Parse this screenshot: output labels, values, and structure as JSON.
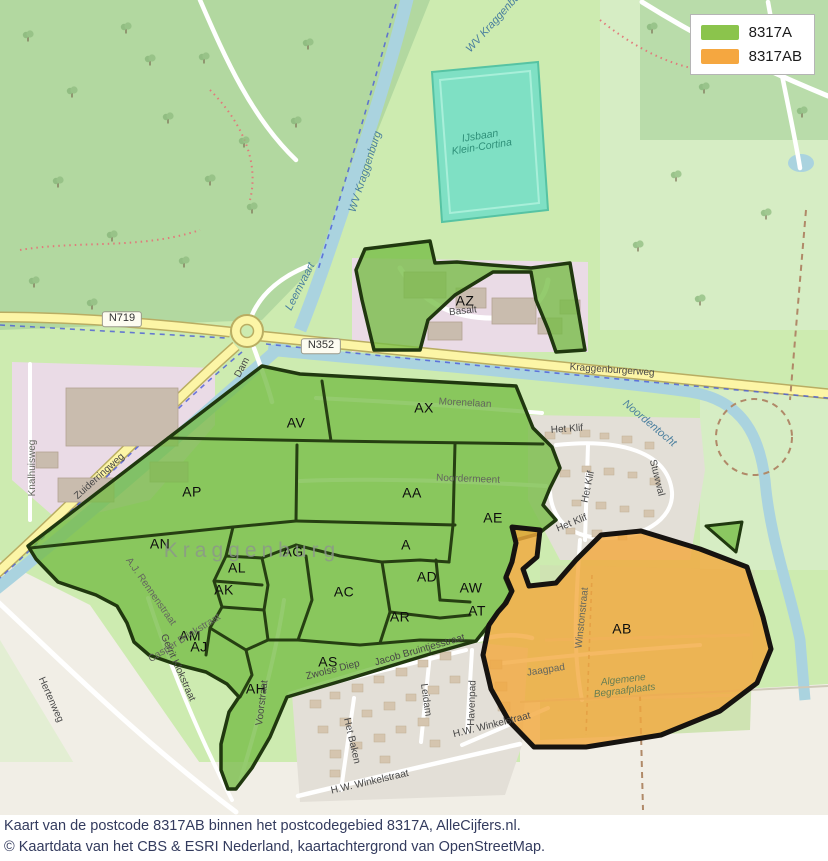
{
  "legend": {
    "items": [
      {
        "label": "8317A",
        "color": "#8bc44c"
      },
      {
        "label": "8317AB",
        "color": "#f5a740"
      }
    ]
  },
  "caption": {
    "line1": "Kaart van de postcode 8317AB binnen het postcodegebied 8317A, AlleCijfers.nl.",
    "line2": "© Kaartdata van het CBS & ESRI Nederland, kaartachtergrond van OpenStreetMap."
  },
  "map": {
    "colors": {
      "region_green_fill": "#76bc45",
      "region_orange_fill": "#f3a73c",
      "region_border_green": "#20380f",
      "region_border_black": "#161310",
      "water": "#aad3df",
      "road_yellow": "#fcf5a6",
      "forest": "#b2d8a0",
      "industrial_pink": "#eadbe6",
      "residential_grey": "#e3dfd7",
      "beige": "#f1eee6"
    },
    "labels": [
      {
        "kind": "region",
        "name": "region-label-az",
        "text": "AZ",
        "x": 465,
        "y": 301,
        "rot": 0
      },
      {
        "kind": "region",
        "name": "region-label-ax",
        "text": "AX",
        "x": 424,
        "y": 408,
        "rot": 0
      },
      {
        "kind": "region",
        "name": "region-label-av",
        "text": "AV",
        "x": 296,
        "y": 423,
        "rot": 0
      },
      {
        "kind": "region",
        "name": "region-label-ap",
        "text": "AP",
        "x": 192,
        "y": 492,
        "rot": 0
      },
      {
        "kind": "region",
        "name": "region-label-aa",
        "text": "AA",
        "x": 412,
        "y": 493,
        "rot": 0
      },
      {
        "kind": "region",
        "name": "region-label-ae",
        "text": "AE",
        "x": 493,
        "y": 518,
        "rot": 0
      },
      {
        "kind": "region",
        "name": "region-label-an",
        "text": "AN",
        "x": 160,
        "y": 544,
        "rot": 0
      },
      {
        "kind": "region",
        "name": "region-label-a",
        "text": "A",
        "x": 406,
        "y": 545,
        "rot": 0
      },
      {
        "kind": "region",
        "name": "region-label-ag",
        "text": "AG",
        "x": 293,
        "y": 552,
        "rot": 0
      },
      {
        "kind": "region",
        "name": "region-label-al",
        "text": "AL",
        "x": 237,
        "y": 568,
        "rot": 0
      },
      {
        "kind": "region",
        "name": "region-label-ak",
        "text": "AK",
        "x": 224,
        "y": 590,
        "rot": 0
      },
      {
        "kind": "region",
        "name": "region-label-ac",
        "text": "AC",
        "x": 344,
        "y": 592,
        "rot": 0
      },
      {
        "kind": "region",
        "name": "region-label-ad",
        "text": "AD",
        "x": 427,
        "y": 577,
        "rot": 0
      },
      {
        "kind": "region",
        "name": "region-label-aw",
        "text": "AW",
        "x": 471,
        "y": 588,
        "rot": 0
      },
      {
        "kind": "region",
        "name": "region-label-ar",
        "text": "AR",
        "x": 400,
        "y": 617,
        "rot": 0
      },
      {
        "kind": "region",
        "name": "region-label-at",
        "text": "AT",
        "x": 477,
        "y": 611,
        "rot": 0
      },
      {
        "kind": "region",
        "name": "region-label-am",
        "text": "AM",
        "x": 190,
        "y": 636,
        "rot": 0
      },
      {
        "kind": "region",
        "name": "region-label-aj",
        "text": "AJ",
        "x": 199,
        "y": 647,
        "rot": 0
      },
      {
        "kind": "region",
        "name": "region-label-ab",
        "text": "AB",
        "x": 622,
        "y": 629,
        "rot": 0
      },
      {
        "kind": "region",
        "name": "region-label-as",
        "text": "AS",
        "x": 328,
        "y": 662,
        "rot": 0
      },
      {
        "kind": "region",
        "name": "region-label-ah",
        "text": "AH",
        "x": 256,
        "y": 689,
        "rot": 0
      },
      {
        "kind": "shield",
        "name": "road-shield-n719",
        "text": "N719",
        "x": 122,
        "y": 319,
        "rot": 0
      },
      {
        "kind": "shield",
        "name": "road-shield-n352",
        "text": "N352",
        "x": 321,
        "y": 346,
        "rot": 0
      },
      {
        "kind": "street",
        "name": "street-label-kraggenburgerweg",
        "text": "Kraggenburgerweg",
        "x": 612,
        "y": 371,
        "rot": 4
      },
      {
        "kind": "street",
        "name": "street-label-zuiderringweg",
        "text": "Zuiderringweg",
        "x": 100,
        "y": 477,
        "rot": -42
      },
      {
        "kind": "street",
        "name": "street-label-dam",
        "text": "Dam",
        "x": 243,
        "y": 368,
        "rot": -62
      },
      {
        "kind": "street-dim",
        "name": "street-label-knalhuisweg",
        "text": "Knalhuisweg",
        "x": 33,
        "y": 468,
        "rot": -90
      },
      {
        "kind": "street",
        "name": "street-label-basalt",
        "text": "Basalt",
        "x": 463,
        "y": 312,
        "rot": -6
      },
      {
        "kind": "street-dim",
        "name": "street-label-morenelaan",
        "text": "Morenelaan",
        "x": 465,
        "y": 404,
        "rot": 3
      },
      {
        "kind": "street-dim",
        "name": "street-label-noordermeent",
        "text": "Noordermeent",
        "x": 468,
        "y": 480,
        "rot": 2
      },
      {
        "kind": "street",
        "name": "street-label-het-klif-1",
        "text": "Het Klif",
        "x": 567,
        "y": 430,
        "rot": -4
      },
      {
        "kind": "street",
        "name": "street-label-het-klif-2",
        "text": "Het Klif",
        "x": 589,
        "y": 487,
        "rot": -78
      },
      {
        "kind": "street",
        "name": "street-label-het-klif-3",
        "text": "Het Klif",
        "x": 572,
        "y": 524,
        "rot": -22
      },
      {
        "kind": "street",
        "name": "street-label-stuwwal",
        "text": "Stuwwal",
        "x": 656,
        "y": 478,
        "rot": 76
      },
      {
        "kind": "street-dim",
        "name": "street-label-winstonstraat",
        "text": "Winstonstraat",
        "x": 583,
        "y": 618,
        "rot": -84
      },
      {
        "kind": "street-dim",
        "name": "street-label-jaagpad",
        "text": "Jaagpad",
        "x": 546,
        "y": 671,
        "rot": -9
      },
      {
        "kind": "street",
        "name": "street-label-jacob-bruintjesstraat",
        "text": "Jacob Bruintjesstraat",
        "x": 420,
        "y": 651,
        "rot": -16
      },
      {
        "kind": "street",
        "name": "street-label-zwolse-diep",
        "text": "Zwolse Diep",
        "x": 333,
        "y": 671,
        "rot": -14
      },
      {
        "kind": "street",
        "name": "street-label-leidam",
        "text": "Leidam",
        "x": 425,
        "y": 700,
        "rot": 82
      },
      {
        "kind": "street",
        "name": "street-label-havenpad",
        "text": "Havenpad",
        "x": 473,
        "y": 703,
        "rot": -88
      },
      {
        "kind": "street",
        "name": "street-label-het-baken",
        "text": "Het Baken",
        "x": 351,
        "y": 741,
        "rot": 77
      },
      {
        "kind": "street",
        "name": "street-label-hw-winkelstraat-1",
        "text": "H.W. Winkelstraat",
        "x": 370,
        "y": 783,
        "rot": -13
      },
      {
        "kind": "street",
        "name": "street-label-hw-winkelstraat-2",
        "text": "H.W. Winkelstraat",
        "x": 492,
        "y": 726,
        "rot": -14
      },
      {
        "kind": "street",
        "name": "street-label-voorstraat",
        "text": "Voorstraat",
        "x": 263,
        "y": 703,
        "rot": -83
      },
      {
        "kind": "street",
        "name": "street-label-gerrit-klokstraat",
        "text": "Gerrit Klokstraat",
        "x": 177,
        "y": 668,
        "rot": 66
      },
      {
        "kind": "street",
        "name": "street-label-hertenweg",
        "text": "Hertenweg",
        "x": 50,
        "y": 700,
        "rot": 66
      },
      {
        "kind": "street-dim",
        "name": "street-label-casper-brinkstraat",
        "text": "Casper Brinkstraat",
        "x": 185,
        "y": 639,
        "rot": -32
      },
      {
        "kind": "street-dim",
        "name": "street-label-aj-rennenstraat",
        "text": "A.J. Rennenstraat",
        "x": 150,
        "y": 592,
        "rot": 55
      },
      {
        "kind": "water",
        "name": "water-label-wv-kraggenburg",
        "text": "WV Kraggenburg",
        "x": 366,
        "y": 172,
        "rot": -72
      },
      {
        "kind": "water",
        "name": "water-label-wv-kraggenburg-top",
        "text": "WV Kraggenburg",
        "x": 497,
        "y": 20,
        "rot": -48
      },
      {
        "kind": "water",
        "name": "water-label-leemvaart",
        "text": "Leemvaart",
        "x": 301,
        "y": 287,
        "rot": -63
      },
      {
        "kind": "water",
        "name": "water-label-noordentocht",
        "text": "Noordentocht",
        "x": 649,
        "y": 424,
        "rot": 40
      },
      {
        "kind": "place",
        "name": "place-label-ijsbaan",
        "text": "IJsbaan\nKlein-Cortina",
        "x": 481,
        "y": 142,
        "rot": -9
      },
      {
        "kind": "watermark",
        "name": "place-label-kraggenburg",
        "text": "Kraggenburg",
        "x": 252,
        "y": 551,
        "rot": 0
      },
      {
        "kind": "cemetery",
        "name": "place-label-begraafplaats",
        "text": "Algemene\nBegraafplaats",
        "x": 624,
        "y": 686,
        "rot": -7
      }
    ]
  }
}
